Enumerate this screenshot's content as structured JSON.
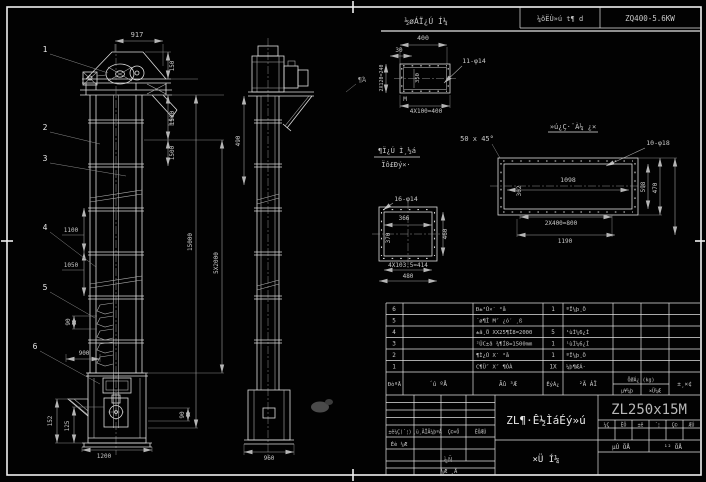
{
  "top": {
    "view_title": "½øÁÏ¿Ú Í¼",
    "view_scale": "400",
    "gearbox_label": "¼õËÙ»ú t¶ d",
    "gearbox_model": "ZQ400-5.6KW"
  },
  "balloons": {
    "n1": "1",
    "n2": "2",
    "n3": "3",
    "n4": "4",
    "n5": "5",
    "n6": "6"
  },
  "front": {
    "dim_917": "917",
    "dim_150": "150",
    "dim_1500a": "1500",
    "dim_1500b": "1500",
    "dim_15000": "15000",
    "dim_5x2000": "5X2000",
    "dim_1100": "1100",
    "dim_1050": "1050",
    "dim_90": "90",
    "dim_900": "900",
    "dim_152": "152",
    "dim_125": "125",
    "dim_1200": "1200",
    "dim_90b": "90"
  },
  "side": {
    "dim_490": "490",
    "dim_960": "960",
    "weld_note": "¶Ά"
  },
  "channel": {
    "dim_400": "400",
    "dim_30": "30",
    "dim_350": "350",
    "dim_240": "2X120=240",
    "holes": "11-φ14",
    "note_m": "M",
    "dim_4x100": "4X100=400"
  },
  "rect_detail": {
    "title": "»ú¿Ç·¨À¼ ¿×",
    "chamfer": "50 x 45°",
    "holes": "10-φ18",
    "dim_1098": "1098",
    "dim_302": "302",
    "dim_598": "598",
    "dim_470": "470",
    "dim_800": "2X400=800",
    "dim_1190": "1190"
  },
  "square_detail": {
    "title_top": "¶Ï¿Ú Ì¸½á",
    "title_bottom": "Ïô£Ðý×·",
    "holes": "16-φ14",
    "dim_366": "366",
    "dim_370": "370",
    "dim_460": "460",
    "dim_414": "4X103.5=414",
    "dim_480": "480"
  },
  "bom": {
    "headers": {
      "no": "ÐòºÅ",
      "code": "´ú ºÅ",
      "name": "Ãû ³Æ",
      "qty": "ÊýÁ¿",
      "material": "²Ä ÁÏ",
      "weight": "ÖØÁ¿ (kg)",
      "unit": "µ¥¼þ",
      "total": "×Ü¼Æ",
      "remark": "±¸×¢"
    },
    "rows": [
      {
        "no": "6",
        "code": "",
        "name": "Ð±²Û×′ °å",
        "qty": "1",
        "material": "ºÏ¼þ¸Ö",
        "unit": "",
        "total": "",
        "remark": ""
      },
      {
        "no": "5",
        "code": "",
        "name": "´ø¶Ì M″ ¿ó′ ¸ß",
        "qty": "",
        "material": "",
        "unit": "",
        "total": "",
        "remark": ""
      },
      {
        "no": "4",
        "code": "",
        "name": "±â¸Ö XX25¶Í8=2000",
        "qty": "5",
        "material": "¹ùÌ¼6¿Í",
        "unit": "",
        "total": "",
        "remark": ""
      },
      {
        "no": "3",
        "code": "",
        "name": "²ÛC±â ¾¶Í8=1500mm",
        "qty": "1",
        "material": "¹ùÌ¼6¿Í",
        "unit": "",
        "total": "",
        "remark": ""
      },
      {
        "no": "2",
        "code": "",
        "name": "¶Ì¿Û X′ °å",
        "qty": "1",
        "material": "ºÏ¼þ¸Ö",
        "unit": "",
        "total": "",
        "remark": ""
      },
      {
        "no": "1",
        "code": "",
        "name": "C¶Ü″ X″ ¶ÓÀ",
        "qty": "1X",
        "material": "¼þ¶ÆÁ·",
        "unit": "",
        "total": "",
        "remark": ""
      }
    ]
  },
  "title_block": {
    "model": "ZL250x15M",
    "title": "ZL¶·Ê½ÌáÉý»ú",
    "subtitle": "×Ü  Í¼",
    "rev_h1": "±ê¼Ç(´¦)",
    "rev_h2": "¸ü¸ÄÎÄ¼þºÅ",
    "rev_h3": "Ç©×Ö",
    "rev_h4": "ÈÕÆÚ",
    "row_design": "Éè ¼Æ",
    "stamp": "¼Ñ",
    "bottom_note": "¼Æ ¸Å",
    "sh1": "¼Ç",
    "sh2": "ÈÕ",
    "sh3": "±ê",
    "sh4": "´¦",
    "sh5": "Ç©",
    "sh6": "ÆÚ",
    "sheet_no": "µÚ  ÕÅ",
    "sheet_total": "¹²  ÕÅ"
  }
}
